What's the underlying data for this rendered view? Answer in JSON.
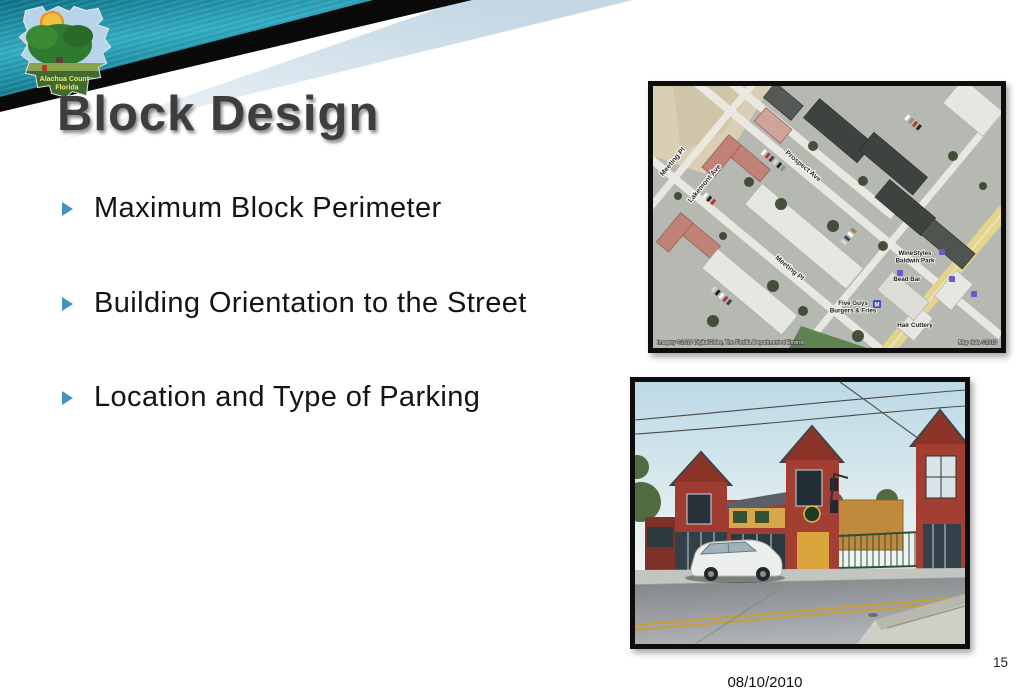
{
  "header": {
    "title": "Block Design",
    "logo": {
      "name_line1": "Alachua County,",
      "name_line2": "Florida"
    }
  },
  "bullets": [
    "Maximum Block Perimeter",
    "Building Orientation to the Street",
    "Location and Type of Parking"
  ],
  "footer": {
    "date": "08/10/2010",
    "page_number": "15"
  },
  "aerial_map": {
    "street_labels": {
      "meeting_pl_upper": "Meeting Pl",
      "lakemont_ave": "Lakemont Ave",
      "prospect_ave": "Prospect Ave",
      "meeting_pl_lower": "Meeting Pl"
    },
    "poi_labels": {
      "winestyles_line1": "WineStyles",
      "winestyles_line2": "Baldwin Park",
      "bead_bar": "Bead Bar",
      "five_guys_line1": "Five Guys",
      "five_guys_line2": "Burgers & Fries",
      "hair_cuttery": "Hair Cuttery",
      "metro_m": "M"
    },
    "attribution_left": "Imagery ©2010 DigitalGlobe, The Florida Department of Environ",
    "attribution_right": "Map data ©2010"
  },
  "icons": {
    "bullet": "triangle-right",
    "map_poi": "shopping-bag",
    "map_transit": "metro-m"
  },
  "colors": {
    "accent_teal": "#2fa9c0",
    "dark_teal": "#0a6173",
    "pale_blue": "#cfdfe9",
    "black_band": "#0a0a0a",
    "title_gray": "#3e3e3e",
    "bullet_arrow": "#4294b8",
    "map_road_yellow": "#e3d48e",
    "photo_brick_red": "#9e3c31"
  }
}
